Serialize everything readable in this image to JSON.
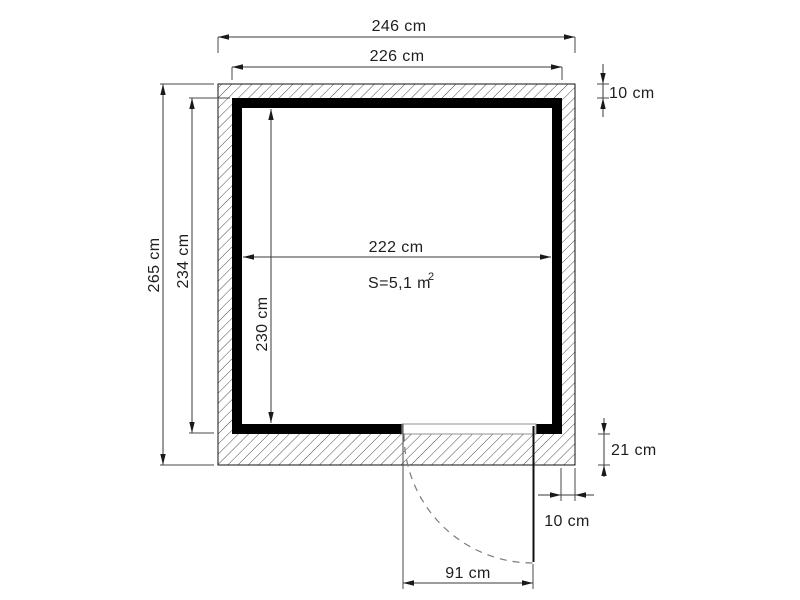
{
  "drawing": {
    "description_labels": {
      "outer_width": "246 cm",
      "wall_outer_width": "226 cm",
      "roof_overhang_top": "10 cm",
      "outer_depth": "265 cm",
      "wall_outer_depth": "234 cm",
      "interior_depth": "230 cm",
      "interior_width": "222 cm",
      "floor_area": "S=5,1 m",
      "floor_area_exponent": "2",
      "base_edge_bottom": "21 cm",
      "side_overhang_bottom": "10 cm",
      "door_opening_width": "91 cm"
    },
    "colors": {
      "wall": "#000000",
      "dimension_lines": "#3a3a3a",
      "hatch_lines": "#3c3c3c",
      "dashed_door_arc": "#7a7a7a",
      "background": "#ffffff"
    }
  }
}
